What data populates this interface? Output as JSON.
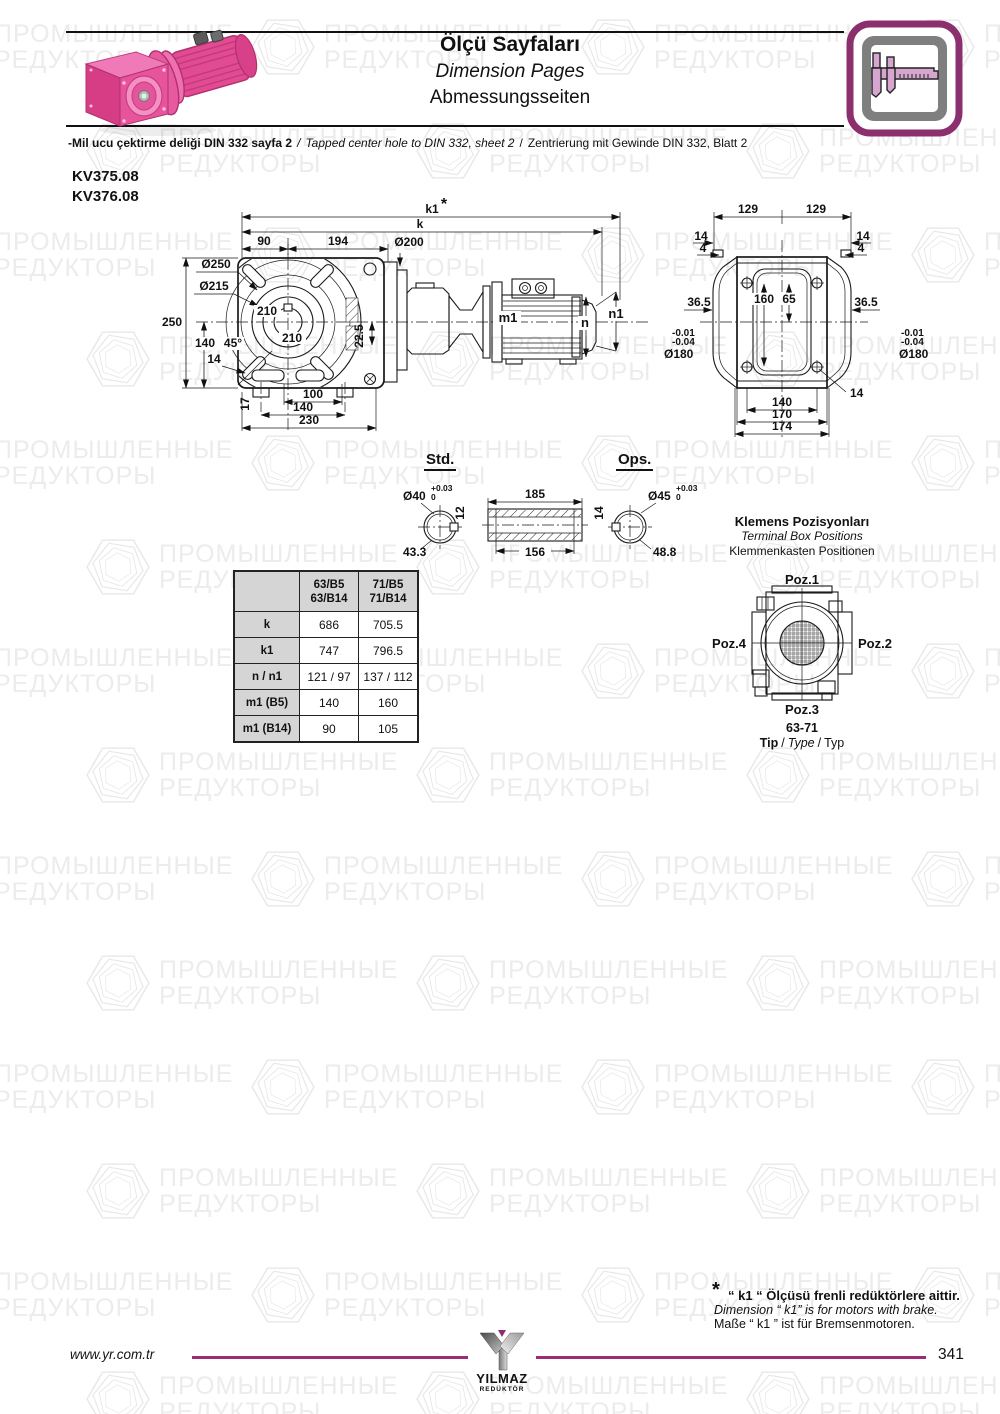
{
  "header": {
    "title_tr": "Ölçü Sayfaları",
    "title_en": "Dimension Pages",
    "title_de": "Abmessungsseiten"
  },
  "note": {
    "tr": "-Mil ucu çektirme deliği DIN 332 sayfa 2",
    "sep": "/",
    "en": "Tapped center hole to DIN 332, sheet 2",
    "de": "Zentrierung mit Gewinde DIN 332, Blatt 2"
  },
  "models": {
    "m1": "KV375.08",
    "m2": "KV376.08"
  },
  "front_view": {
    "star": "*",
    "k1": "k1",
    "k": "k",
    "dim_90": "90",
    "dim_194": "194",
    "dia_200": "Ø200",
    "dia_250": "Ø250",
    "dia_215": "Ø215",
    "dim_250": "250",
    "dim_140": "140",
    "angle_45": "45°",
    "dim_14": "14",
    "dim_210a": "210",
    "dim_210b": "210",
    "dim_22_5": "22.5",
    "dim_17": "17",
    "dim_100": "100",
    "dim_140b": "140",
    "dim_230": "230",
    "m1": "m1",
    "n": "n",
    "n1": "n1"
  },
  "rear_view": {
    "dim_129a": "129",
    "dim_129b": "129",
    "dim_14_left": "14",
    "dim_4_left": "4",
    "dim_14_right": "14",
    "dim_4_right": "4",
    "dim_36_5_left": "36.5",
    "dim_36_5_right": "36.5",
    "dim_160": "160",
    "dim_65": "65",
    "tol_left_1": "-0.01",
    "tol_left_2": "-0.04",
    "dia_180_left": "Ø180",
    "tol_right_1": "-0.01",
    "tol_right_2": "-0.04",
    "dia_180_right": "Ø180",
    "dim_14_hole": "14",
    "dim_140": "140",
    "dim_170": "170",
    "dim_174": "174"
  },
  "shafts": {
    "std_label": "Std.",
    "ops_label": "Ops.",
    "std_dia": "Ø40",
    "std_tol_plus": "+0.03",
    "std_tol_zero": "0",
    "std_key": "12",
    "std_flat": "43.3",
    "len_outer": "185",
    "len_inner": "156",
    "ops_dia": "Ø45",
    "ops_tol_plus": "+0.03",
    "ops_tol_zero": "0",
    "ops_key": "14",
    "ops_flat": "48.8"
  },
  "table": {
    "columns": [
      {
        "line1": "63/B5",
        "line2": "63/B14"
      },
      {
        "line1": "71/B5",
        "line2": "71/B14"
      }
    ],
    "rows": [
      {
        "label": "k",
        "v1": "686",
        "v2": "705.5"
      },
      {
        "label": "k1",
        "v1": "747",
        "v2": "796.5"
      },
      {
        "label": "n / n1",
        "v1": "121 / 97",
        "v2": "137 / 112"
      },
      {
        "label": "m1 (B5)",
        "v1": "140",
        "v2": "160"
      },
      {
        "label": "m1 (B14)",
        "v1": "90",
        "v2": "105"
      }
    ]
  },
  "terminal_box": {
    "title_tr": "Klemens Pozisyonları",
    "title_en": "Terminal Box Positions",
    "title_de": "Klemmenkasten Positionen",
    "poz1": "Poz.1",
    "poz2": "Poz.2",
    "poz3": "Poz.3",
    "poz4": "Poz.4",
    "type_range": "63-71",
    "tip_tr": "Tip",
    "sep": "/",
    "tip_en": "Type",
    "tip_de": "Typ"
  },
  "footnote": {
    "star": "*",
    "tr": "“ k1 “ Ölçüsü frenli redüktörlere aittir.",
    "en": "Dimension “ k1” is for motors with brake.",
    "de": "Maße “ k1 ” ist für Bremsenmotoren."
  },
  "footer": {
    "website": "www.yr.com.tr",
    "logo_text": "YILMAZ",
    "logo_sub": "REDÜKTÖR",
    "page": "341"
  },
  "watermark": {
    "line1": "ПРОМЫШЛЕННЫЕ",
    "line2": "РЕДУКТОРЫ"
  },
  "colors": {
    "accent_magenta": "#9b2d78",
    "icon_border": "#8b2f6e",
    "motor_pink": "#e24a92",
    "table_header_gray": "#d5d5d5",
    "drawing_ink": "#1a1a1a",
    "watermark_gray": "#ececec"
  }
}
